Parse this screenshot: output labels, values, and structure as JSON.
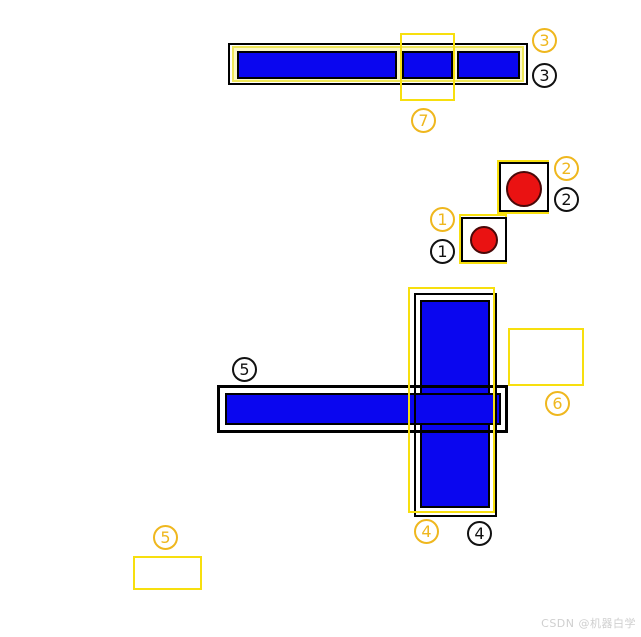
{
  "colors": {
    "bar_blue": "#0A06EF",
    "circle_red": "#EA1212",
    "box_yellow": "#F7DF0E",
    "label_yellow": "#EFB71E",
    "outline_black": "#000000",
    "topbar_fill": "#FBF8C6",
    "watermark_gray": "#CFCFCF",
    "background": "#FFFFFF"
  },
  "labels": [
    {
      "digit": "3",
      "variant": "yellow"
    },
    {
      "digit": "3",
      "variant": "black"
    },
    {
      "digit": "7",
      "variant": "yellow"
    },
    {
      "digit": "2",
      "variant": "yellow"
    },
    {
      "digit": "2",
      "variant": "black"
    },
    {
      "digit": "1",
      "variant": "yellow"
    },
    {
      "digit": "1",
      "variant": "black"
    },
    {
      "digit": "5",
      "variant": "black"
    },
    {
      "digit": "6",
      "variant": "yellow"
    },
    {
      "digit": "4",
      "variant": "yellow"
    },
    {
      "digit": "4",
      "variant": "black"
    },
    {
      "digit": "5",
      "variant": "yellow"
    }
  ],
  "figures": [
    {
      "num": "3",
      "outlines": [
        "yellow",
        "black"
      ],
      "content": "long horizontal blue bar in 3 segments, top"
    },
    {
      "num": "7",
      "outlines": [
        "yellow"
      ],
      "content": "empty yellow box overlapping top bar middle"
    },
    {
      "num": "2",
      "outlines": [
        "yellow",
        "black"
      ],
      "content": "red filled circle in small box"
    },
    {
      "num": "1",
      "outlines": [
        "yellow",
        "black"
      ],
      "content": "red filled circle in smaller box"
    },
    {
      "num": "4",
      "outlines": [
        "yellow",
        "black"
      ],
      "content": "vertical blue bar of cross"
    },
    {
      "num": "5",
      "outlines": [
        "black"
      ],
      "content": "horizontal blue bar of cross"
    },
    {
      "num": "6",
      "outlines": [
        "yellow"
      ],
      "content": "empty yellow box right of cross"
    },
    {
      "num": "5b",
      "outlines": [
        "yellow"
      ],
      "content": "empty yellow box bottom left"
    }
  ],
  "watermark": {
    "text": "CSDN @机器白学"
  }
}
